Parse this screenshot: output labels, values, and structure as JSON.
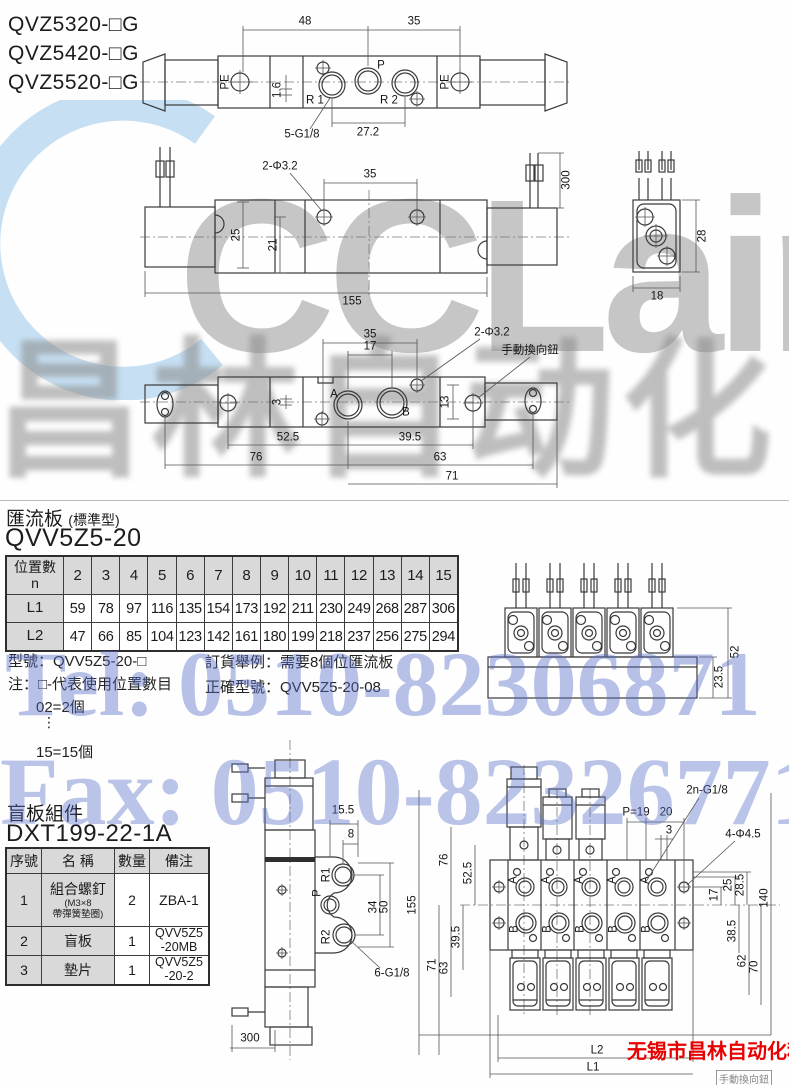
{
  "models": [
    "QVZ5320-□G",
    "QVZ5420-□G",
    "QVZ5520-□G"
  ],
  "sv": {
    "d48": "48",
    "d35": "35",
    "pe": "PE",
    "p": "P",
    "r1": "R 1",
    "r2": "R 2",
    "d16": "1.6",
    "g18": "5-G1/8",
    "d272": "27.2"
  },
  "tv": {
    "hole": "2-Φ3.2",
    "d35": "35",
    "d300": "300",
    "d25": "25",
    "d21": "21",
    "d155": "155"
  },
  "ev": {
    "d28": "28",
    "d18": "18"
  },
  "bv": {
    "d35": "35",
    "d17": "17",
    "hole": "2-Φ3.2",
    "knob": "手動換向鈕",
    "a": "A",
    "b": "B",
    "d3": "3",
    "d13": "13",
    "d525": "52.5",
    "d395": "39.5",
    "d76": "76",
    "d63": "63",
    "d71": "71"
  },
  "mf": {
    "title": "匯流板",
    "sub": "(標準型)",
    "model": "QVV5Z5-20",
    "h1": "位置數",
    "h2": "n",
    "pos": [
      "2",
      "3",
      "4",
      "5",
      "6",
      "7",
      "8",
      "9",
      "10",
      "11",
      "12",
      "13",
      "14",
      "15"
    ],
    "l1": "L1",
    "l1v": [
      "59",
      "78",
      "97",
      "116",
      "135",
      "154",
      "173",
      "192",
      "211",
      "230",
      "249",
      "268",
      "287",
      "306"
    ],
    "l2": "L2",
    "l2v": [
      "47",
      "66",
      "85",
      "104",
      "123",
      "142",
      "161",
      "180",
      "199",
      "218",
      "237",
      "256",
      "275",
      "294"
    ],
    "n1": "型號：QVV5Z5-20-□",
    "n2": "注：□-代表使用位置數目",
    "n3": "02=2個",
    "dots": "⋮",
    "n4": "15=15個",
    "o1": "訂貨舉例：需要8個位匯流板",
    "o2": "正確型號：QVV5Z5-20-08",
    "d52": "52",
    "d235": "23.5"
  },
  "bp": {
    "title": "盲板組件",
    "model": "DXT199-22-1A",
    "hno": "序號",
    "hname": "名 稱",
    "hqty": "數量",
    "hnote": "備注",
    "r": [
      {
        "no": "1",
        "name": "組合螺釘",
        "s1": "(M3×8",
        "s2": "帶彈簧墊圈)",
        "qty": "2",
        "note": "ZBA-1"
      },
      {
        "no": "2",
        "name": "盲板",
        "qty": "1",
        "note": "QVV5Z5",
        "note2": "-20MB"
      },
      {
        "no": "3",
        "name": "墊片",
        "qty": "1",
        "note": "QVV5Z5",
        "note2": "-20-2"
      }
    ]
  },
  "pv": {
    "d155": "15.5",
    "d8": "8",
    "r1": "R1",
    "p": "P",
    "r2": "R2",
    "d34": "34",
    "d50": "50",
    "g18": "6-G1/8",
    "d300": "300"
  },
  "asm": {
    "g18": "2n-G1/8",
    "p19": "P=19",
    "d20": "20",
    "d3": "3",
    "h45": "4-Φ4.5",
    "d155": "155",
    "d71": "71",
    "d76": "76",
    "d525": "52.5",
    "d395": "39.5",
    "d63": "63",
    "d25": "25",
    "d285": "28.5",
    "d17": "17",
    "d140": "140",
    "d385": "38.5",
    "d62": "62",
    "d70": "70",
    "l2": "L2",
    "l1": "L1",
    "a": "A",
    "b": "B"
  },
  "wm": {
    "logo": "CCLair",
    "cn": "昌林自动化",
    "tel": "Tel: 0510-82306871",
    "fax": "Fax: 0510-82326771",
    "co": "无锡市昌林自动化科技",
    "pn": "手動換向鈕"
  }
}
